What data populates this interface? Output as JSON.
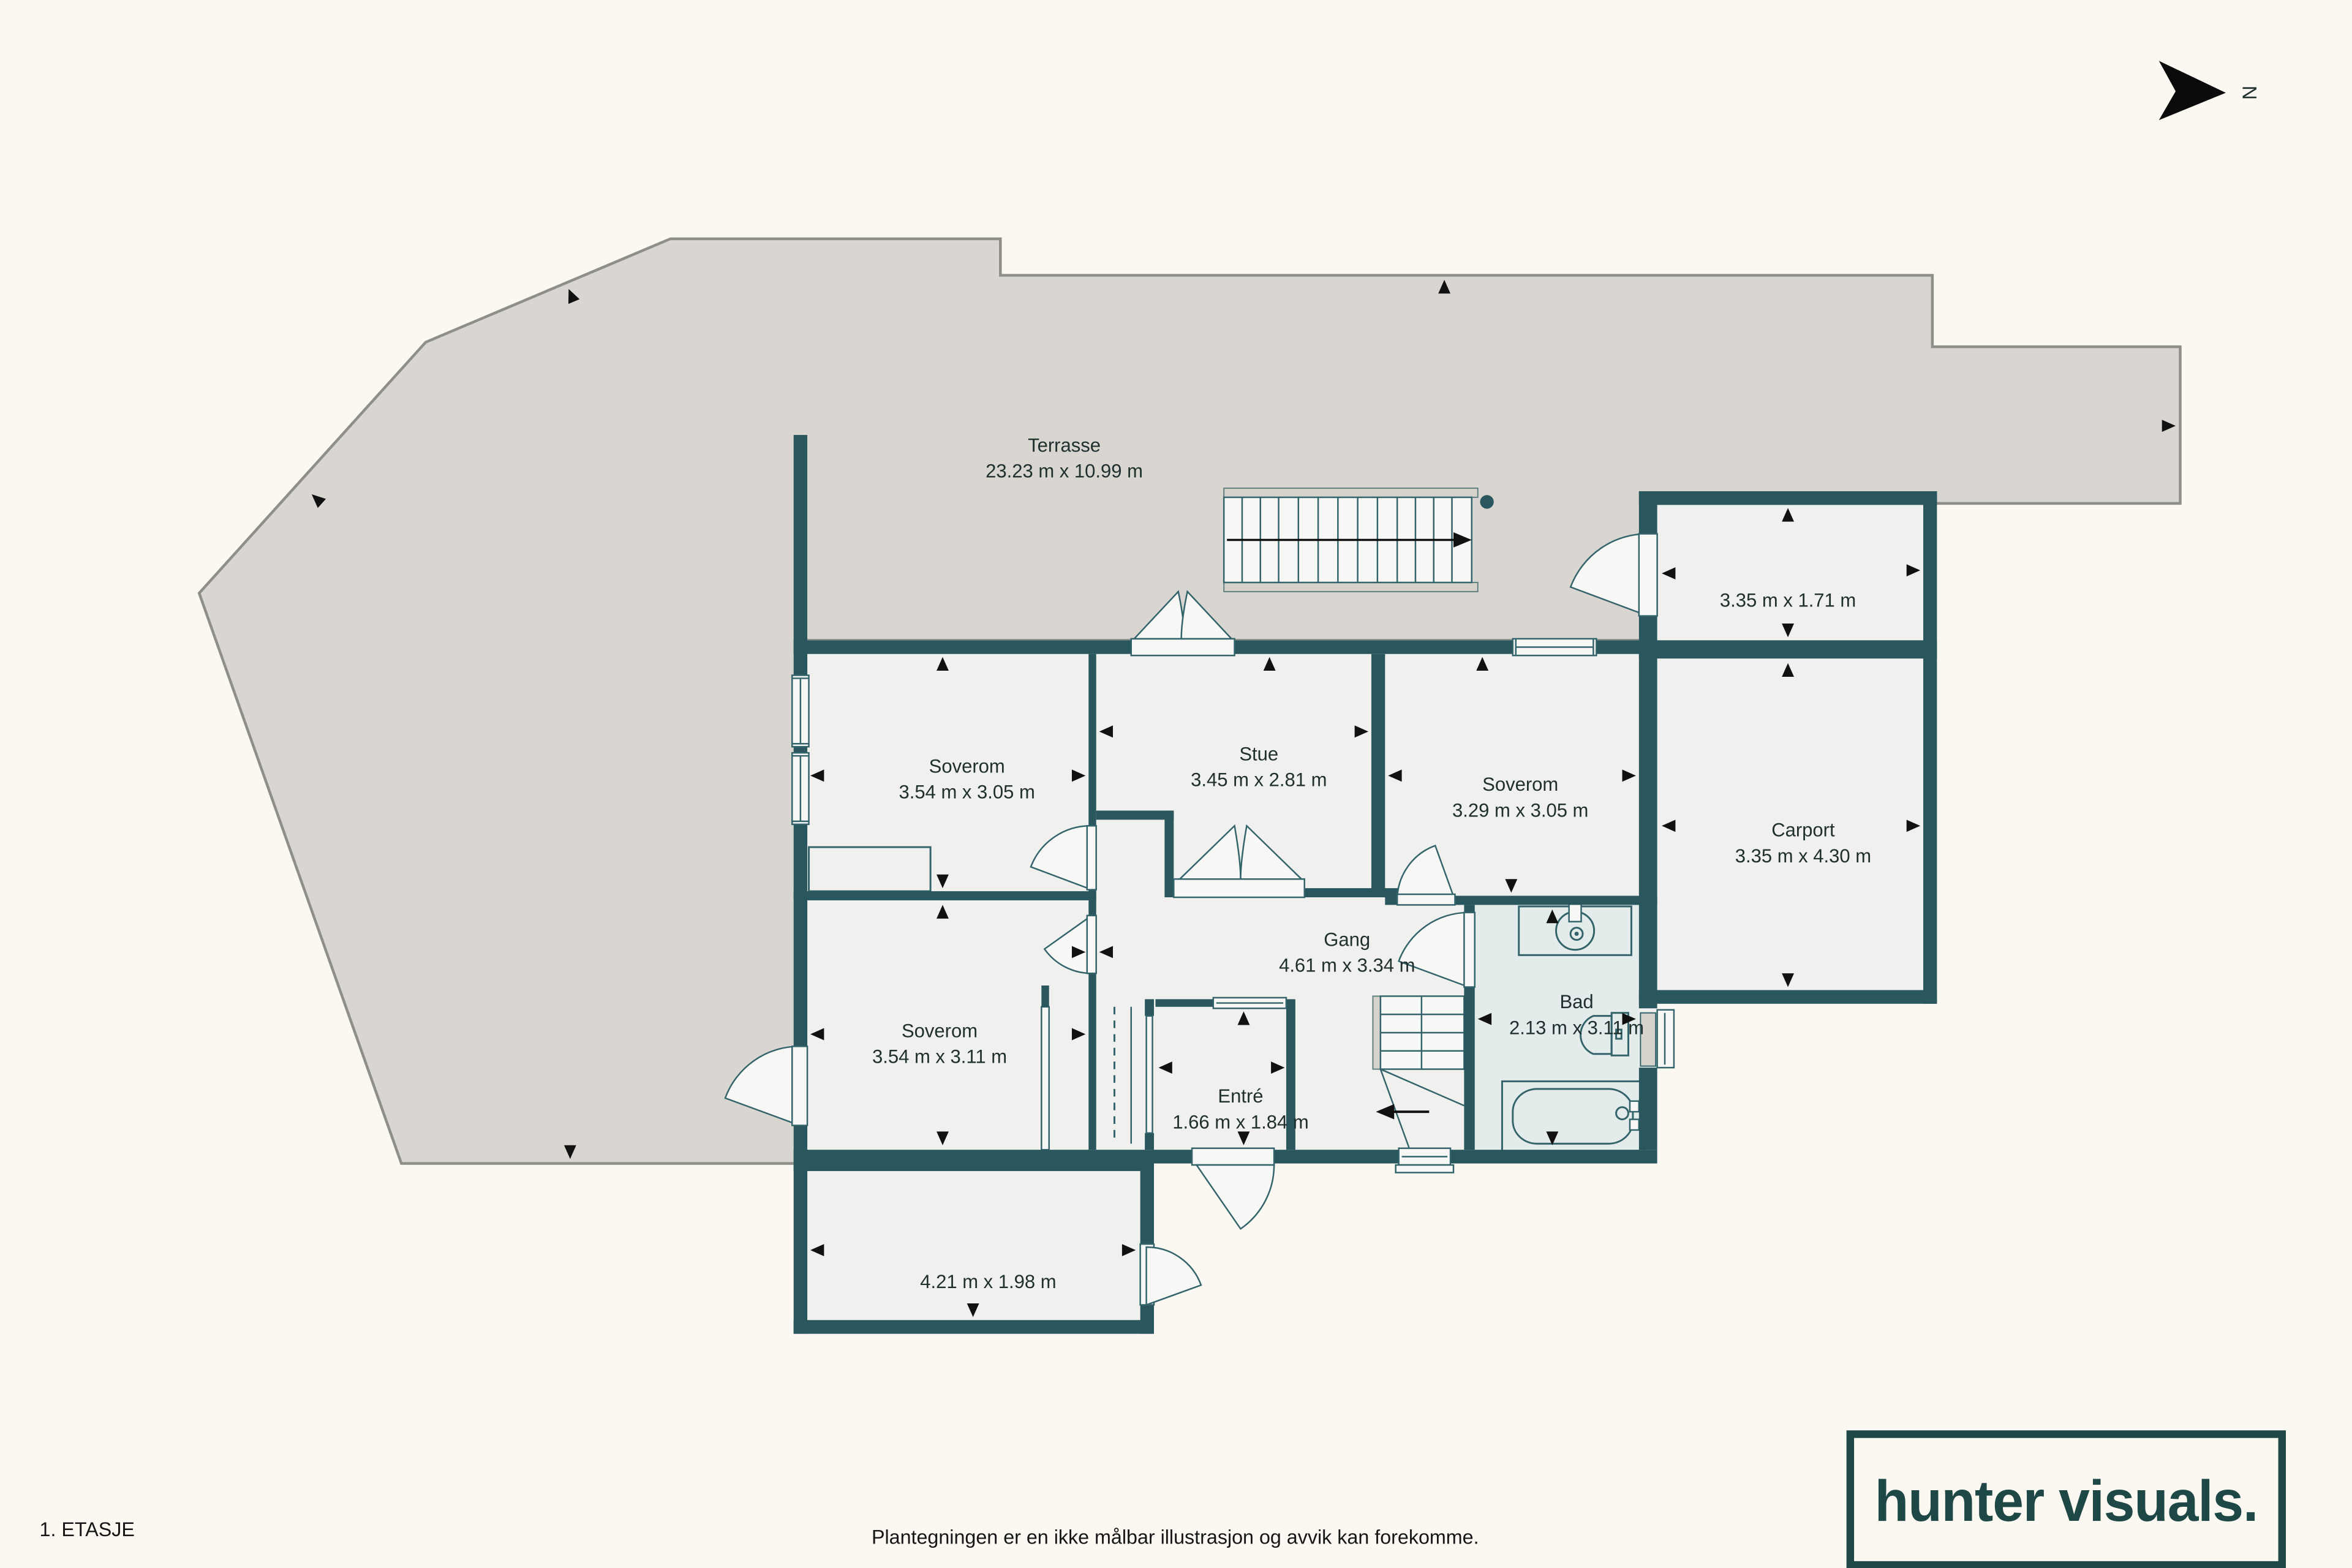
{
  "title_block": {
    "floor_label": "1. ETASJE",
    "disclaimer": "Plantegningen er en ikke målbar illustrasjon og avvik kan forekomme.",
    "logo_text": "hunter visuals."
  },
  "compass": {
    "north_label": "N"
  },
  "rooms": [
    {
      "id": "terrasse",
      "name": "Terrasse",
      "dims": "23.23 m x 10.99 m"
    },
    {
      "id": "soverom-1",
      "name": "Soverom",
      "dims": "3.54 m x 3.05 m"
    },
    {
      "id": "stue",
      "name": "Stue",
      "dims": "3.45 m x 2.81 m"
    },
    {
      "id": "soverom-3",
      "name": "Soverom",
      "dims": "3.29 m x 3.05 m"
    },
    {
      "id": "bod",
      "name": "",
      "dims": "3.35 m x 1.71 m"
    },
    {
      "id": "carport",
      "name": "Carport",
      "dims": "3.35 m x 4.30 m"
    },
    {
      "id": "gang",
      "name": "Gang",
      "dims": "4.61 m x 3.34 m"
    },
    {
      "id": "bad",
      "name": "Bad",
      "dims": "2.13 m x 3.11 m"
    },
    {
      "id": "soverom-2",
      "name": "Soverom",
      "dims": "3.54 m x 3.11 m"
    },
    {
      "id": "entre",
      "name": "Entré",
      "dims": "1.66 m x 1.84 m"
    },
    {
      "id": "kjellerrom",
      "name": "",
      "dims": "4.21 m x 1.98 m"
    }
  ],
  "colors": {
    "wall": "#2a565e",
    "terrace": "#d9d6d1",
    "floor": "#f0f0ee",
    "bathroom_floor": "#e3ecea",
    "background": "#fbf8f1",
    "logo": "#1d4845"
  }
}
